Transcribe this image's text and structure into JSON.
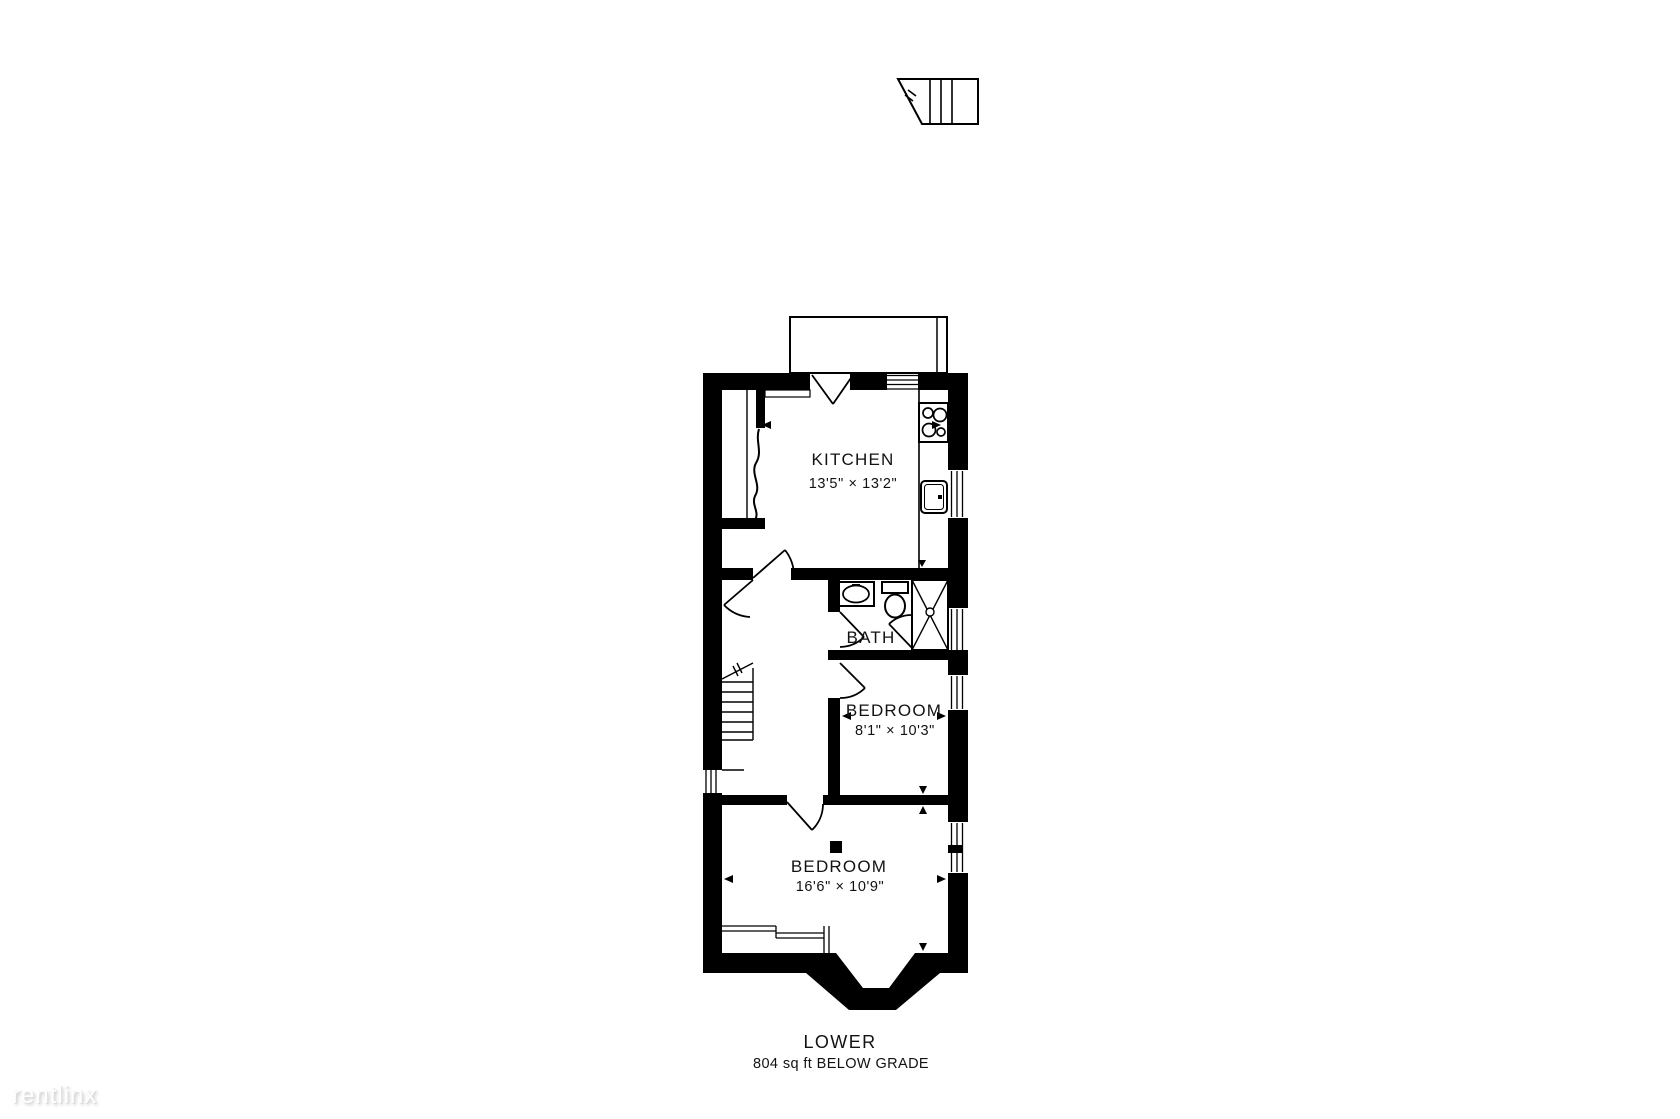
{
  "plan": {
    "floor": {
      "label": "LOWER",
      "area": "804 sq ft BELOW GRADE"
    },
    "rooms": {
      "kitchen": {
        "label": "KITCHEN",
        "dims": "13'5\" × 13'2\""
      },
      "bath": {
        "label": "BATH"
      },
      "bedroom_small": {
        "label": "BEDROOM",
        "dims": "8'1\" × 10'3\""
      },
      "bedroom_large": {
        "label": "BEDROOM",
        "dims": "16'6\" × 10'9\""
      }
    },
    "icons": [
      "exterior-stairs-icon",
      "interior-stairs-icon",
      "stove-icon",
      "kitchen-sink-icon",
      "bath-sink-icon",
      "toilet-icon",
      "shower-icon",
      "door-swing-icon",
      "window-icon",
      "dimension-arrow-icon"
    ],
    "colors": {
      "wall": "#000000",
      "line": "#000000",
      "text": "#121212",
      "background": "#ffffff"
    }
  },
  "watermark": {
    "text": "rentlinx"
  }
}
